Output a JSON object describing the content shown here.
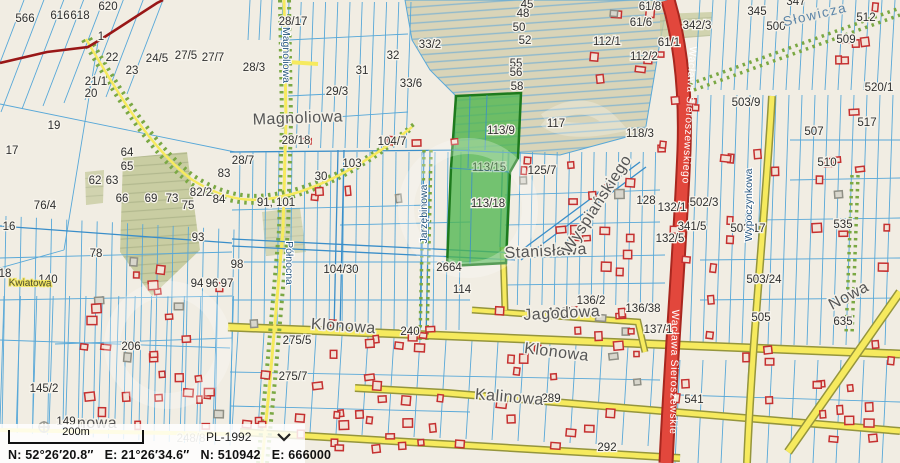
{
  "palette": {
    "bg": "#f1ede3",
    "line": "#58a8d8",
    "line_strong": "#3a8ec9",
    "road_fill": "#f6ea5e",
    "road_casing": "#95953c",
    "road_green": "#7aa843",
    "red_road": "#e2473c",
    "red_road_casing": "#a8271f",
    "admin_boundary": "#991717",
    "green_fill": "#4fb64f",
    "green_stroke": "#1d7a1d",
    "meadow": "#d9d4b8",
    "meadow_line": "#8fb9cc",
    "forest": "#c9cda2",
    "building": "#c53030",
    "building_fill": "#f2e3d8",
    "label": "#2f2f2f",
    "street_label": "#555555",
    "street_label_blue": "#26567f",
    "statusbar_bg": "rgba(255,255,255,0.84)",
    "text": "#111111"
  },
  "map": {
    "highlighted_parcel_numbers": [
      "113/9",
      "113/15",
      "113/18"
    ],
    "parcel_labels": [
      {
        "t": "566",
        "x": 25,
        "y": 22
      },
      {
        "t": "616",
        "x": 60,
        "y": 19
      },
      {
        "t": "618",
        "x": 80,
        "y": 19
      },
      {
        "t": "620",
        "x": 108,
        "y": 10
      },
      {
        "t": "1",
        "x": 101,
        "y": 40
      },
      {
        "t": "22",
        "x": 112,
        "y": 61
      },
      {
        "t": "23",
        "x": 132,
        "y": 74
      },
      {
        "t": "24/5",
        "x": 157,
        "y": 62
      },
      {
        "t": "27/5",
        "x": 186,
        "y": 59
      },
      {
        "t": "27/7",
        "x": 213,
        "y": 61
      },
      {
        "t": "21/1",
        "x": 96,
        "y": 85
      },
      {
        "t": "20",
        "x": 91,
        "y": 97
      },
      {
        "t": "19",
        "x": 54,
        "y": 129
      },
      {
        "t": "17",
        "x": 12,
        "y": 154
      },
      {
        "t": "16",
        "x": 9,
        "y": 230
      },
      {
        "t": "18",
        "x": 5,
        "y": 277
      },
      {
        "t": "76/4",
        "x": 45,
        "y": 209
      },
      {
        "t": "62",
        "x": 95,
        "y": 184
      },
      {
        "t": "63",
        "x": 112,
        "y": 184
      },
      {
        "t": "64",
        "x": 127,
        "y": 156
      },
      {
        "t": "65",
        "x": 127,
        "y": 170
      },
      {
        "t": "66",
        "x": 122,
        "y": 202
      },
      {
        "t": "69",
        "x": 151,
        "y": 202
      },
      {
        "t": "73",
        "x": 172,
        "y": 202
      },
      {
        "t": "75",
        "x": 188,
        "y": 209
      },
      {
        "t": "82/2",
        "x": 201,
        "y": 196
      },
      {
        "t": "83",
        "x": 224,
        "y": 177
      },
      {
        "t": "84",
        "x": 219,
        "y": 203
      },
      {
        "t": "93",
        "x": 198,
        "y": 241
      },
      {
        "t": "94",
        "x": 197,
        "y": 287
      },
      {
        "t": "96",
        "x": 212,
        "y": 287
      },
      {
        "t": "97",
        "x": 227,
        "y": 287
      },
      {
        "t": "78",
        "x": 96,
        "y": 257
      },
      {
        "t": "140",
        "x": 48,
        "y": 283
      },
      {
        "t": "28/17",
        "x": 293,
        "y": 25
      },
      {
        "t": "28/3",
        "x": 254,
        "y": 71
      },
      {
        "t": "29/3",
        "x": 337,
        "y": 95
      },
      {
        "t": "28/18",
        "x": 296,
        "y": 144
      },
      {
        "t": "31",
        "x": 362,
        "y": 74
      },
      {
        "t": "32",
        "x": 393,
        "y": 59
      },
      {
        "t": "33/2",
        "x": 430,
        "y": 48
      },
      {
        "t": "33/6",
        "x": 411,
        "y": 87
      },
      {
        "t": "104/7",
        "x": 392,
        "y": 145
      },
      {
        "t": "103",
        "x": 352,
        "y": 167
      },
      {
        "t": "30",
        "x": 321,
        "y": 180
      },
      {
        "t": "28/7",
        "x": 243,
        "y": 164
      },
      {
        "t": "91, 101",
        "x": 276,
        "y": 206
      },
      {
        "t": "98",
        "x": 237,
        "y": 268
      },
      {
        "t": "104/30",
        "x": 341,
        "y": 273
      },
      {
        "t": "2664",
        "x": 449,
        "y": 271
      },
      {
        "t": "114",
        "x": 462,
        "y": 293
      },
      {
        "t": "45",
        "x": 527,
        "y": 8
      },
      {
        "t": "48",
        "x": 523,
        "y": 17
      },
      {
        "t": "50",
        "x": 519,
        "y": 31
      },
      {
        "t": "52",
        "x": 525,
        "y": 44
      },
      {
        "t": "55",
        "x": 516,
        "y": 67
      },
      {
        "t": "56",
        "x": 516,
        "y": 76
      },
      {
        "t": "58",
        "x": 517,
        "y": 90
      },
      {
        "t": "117",
        "x": 556,
        "y": 127
      },
      {
        "t": "113/9",
        "x": 501,
        "y": 134
      },
      {
        "t": "113/15",
        "x": 489,
        "y": 171,
        "f": 1
      },
      {
        "t": "113/18",
        "x": 488,
        "y": 207
      },
      {
        "t": "125/7",
        "x": 542,
        "y": 174
      },
      {
        "t": "112/1",
        "x": 607,
        "y": 45
      },
      {
        "t": "112/2",
        "x": 644,
        "y": 60
      },
      {
        "t": "61/8",
        "x": 650,
        "y": 10
      },
      {
        "t": "61/6",
        "x": 641,
        "y": 26
      },
      {
        "t": "61/1",
        "x": 669,
        "y": 46
      },
      {
        "t": "118/3",
        "x": 640,
        "y": 137
      },
      {
        "t": "128",
        "x": 646,
        "y": 204
      },
      {
        "t": "132/1",
        "x": 672,
        "y": 211
      },
      {
        "t": "132/5",
        "x": 670,
        "y": 242
      },
      {
        "t": "341/5",
        "x": 692,
        "y": 230
      },
      {
        "t": "502/3",
        "x": 704,
        "y": 206
      },
      {
        "t": "136/2",
        "x": 591,
        "y": 304
      },
      {
        "t": "136/6",
        "x": 562,
        "y": 316
      },
      {
        "t": "136/38",
        "x": 643,
        "y": 312
      },
      {
        "t": "137/1",
        "x": 658,
        "y": 333
      },
      {
        "t": "240",
        "x": 410,
        "y": 335
      },
      {
        "t": "206",
        "x": 131,
        "y": 350
      },
      {
        "t": "145/2",
        "x": 44,
        "y": 392
      },
      {
        "t": "149",
        "x": 66,
        "y": 425
      },
      {
        "t": "248/8",
        "x": 191,
        "y": 442,
        "f": 1
      },
      {
        "t": "275/5",
        "x": 297,
        "y": 344
      },
      {
        "t": "275/7",
        "x": 293,
        "y": 380
      },
      {
        "t": "289",
        "x": 551,
        "y": 402
      },
      {
        "t": "292",
        "x": 607,
        "y": 451
      },
      {
        "t": "342/3",
        "x": 697,
        "y": 29
      },
      {
        "t": "345",
        "x": 757,
        "y": 15
      },
      {
        "t": "347",
        "x": 796,
        "y": 5
      },
      {
        "t": "500",
        "x": 776,
        "y": 30
      },
      {
        "t": "512",
        "x": 866,
        "y": 21
      },
      {
        "t": "509",
        "x": 846,
        "y": 43
      },
      {
        "t": "520/1",
        "x": 879,
        "y": 91
      },
      {
        "t": "517",
        "x": 867,
        "y": 126
      },
      {
        "t": "507",
        "x": 814,
        "y": 135
      },
      {
        "t": "503/9",
        "x": 746,
        "y": 106
      },
      {
        "t": "503/17",
        "x": 748,
        "y": 232
      },
      {
        "t": "503/24",
        "x": 764,
        "y": 283
      },
      {
        "t": "505",
        "x": 761,
        "y": 321
      },
      {
        "t": "510",
        "x": 827,
        "y": 166
      },
      {
        "t": "535",
        "x": 843,
        "y": 228
      },
      {
        "t": "635",
        "x": 843,
        "y": 325
      },
      {
        "t": "541",
        "x": 694,
        "y": 403
      }
    ],
    "street_labels": [
      {
        "t": "Magnoliowa",
        "x": 298,
        "y": 123,
        "r": -2,
        "c": "lbig"
      },
      {
        "t": "Magnoliowa",
        "x": 283,
        "y": 55,
        "r": 90,
        "c": "lv"
      },
      {
        "t": "Północna",
        "x": 286,
        "y": 263,
        "r": 90,
        "c": "lv"
      },
      {
        "t": "Jarzębinowa",
        "x": 427,
        "y": 214,
        "r": -90,
        "c": "lv"
      },
      {
        "t": "Wypoczynkowa",
        "x": 752,
        "y": 205,
        "r": -90,
        "c": "lv"
      },
      {
        "t": "Klonowa",
        "x": 343,
        "y": 331,
        "r": 4,
        "c": "lbig"
      },
      {
        "t": "Klonowa",
        "x": 556,
        "y": 357,
        "r": 7,
        "c": "lbig"
      },
      {
        "t": "Kalinowa",
        "x": 509,
        "y": 402,
        "r": 5,
        "c": "lbig"
      },
      {
        "t": "Jagodowa",
        "x": 562,
        "y": 318,
        "r": -3,
        "c": "lbig"
      },
      {
        "t": "Stanisława",
        "x": 546,
        "y": 256,
        "r": -3,
        "c": "lbig"
      },
      {
        "t": "Wyspiańskiego",
        "x": 601,
        "y": 207,
        "r": -57,
        "c": "lbig"
      },
      {
        "t": "Słowicza",
        "x": 816,
        "y": 19,
        "r": -13,
        "c": "lblue"
      },
      {
        "t": "Nowa",
        "x": 851,
        "y": 300,
        "r": -28,
        "c": "lbig"
      },
      {
        "t": "Kwiatowa",
        "x": 30,
        "y": 286,
        "r": 1,
        "c": "lroad"
      },
      {
        "t": "nowa",
        "x": 97,
        "y": 428,
        "r": 0,
        "c": "lbig"
      },
      {
        "t": "Wacława Sieroszewskiego",
        "x": 686,
        "y": 115,
        "r": 93,
        "c": "lred"
      },
      {
        "t": "Wacława Sieroszewskie",
        "x": 671,
        "y": 372,
        "r": 91,
        "c": "lred"
      }
    ]
  },
  "status_bar": {
    "scale_label": "200m",
    "crs": "PL-1992",
    "coords": {
      "geo_n": "N: 52°26′20.8″",
      "geo_e": "E: 21°26′34.6″",
      "grid_n": "N: 510942",
      "grid_e": "E: 666000"
    }
  }
}
